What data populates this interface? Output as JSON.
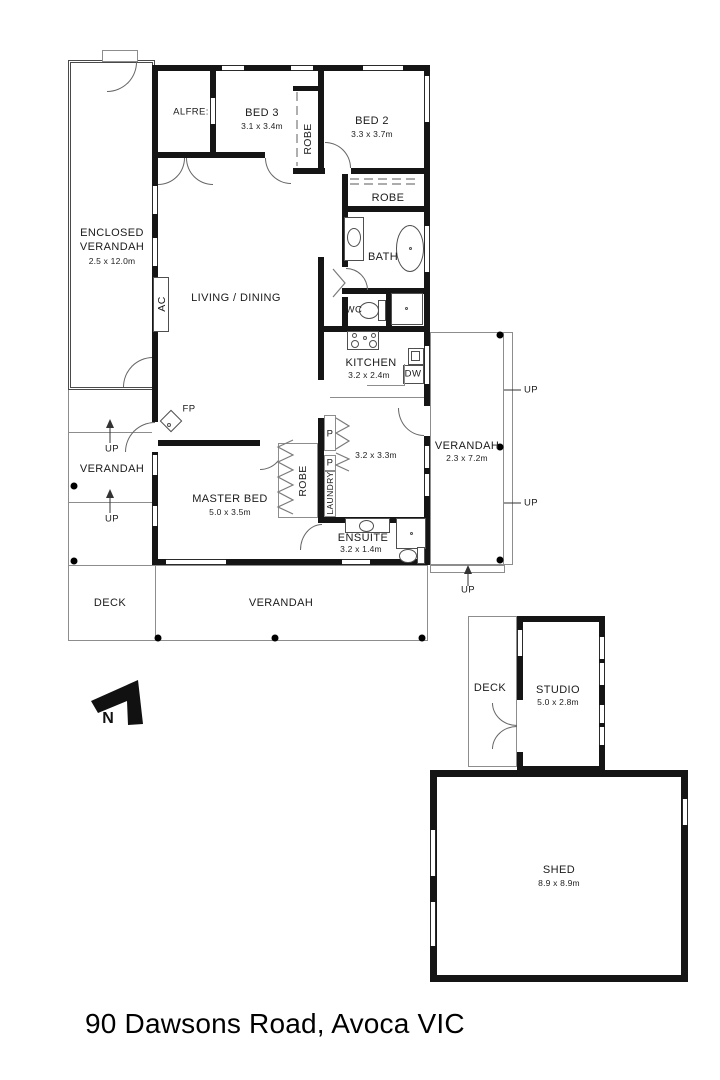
{
  "address_line": "90 Dawsons Road, Avoca VIC",
  "compass": {
    "label": "N"
  },
  "rooms": {
    "enclosed_verandah": {
      "line1": "ENCLOSED",
      "line2": "VERANDAH",
      "dims": "2.5 x 12.0m"
    },
    "alfresco": {
      "name": "ALFRE:"
    },
    "bed3": {
      "name": "BED 3",
      "dims": "3.1 x 3.4m"
    },
    "robe_beds": {
      "name": "ROBE"
    },
    "bed2": {
      "name": "BED 2",
      "dims": "3.3 x 3.7m"
    },
    "robe_hall": {
      "name": "ROBE"
    },
    "bath": {
      "name": "BATH"
    },
    "wc": {
      "name": "WC"
    },
    "living": {
      "name": "LIVING / DINING"
    },
    "ac": {
      "name": "AC"
    },
    "kitchen": {
      "name": "KITCHEN",
      "dims": "3.2 x 2.4m"
    },
    "dw": {
      "name": "DW"
    },
    "meals": {
      "dims": "3.2 x 3.3m"
    },
    "pantry_top": {
      "name": "P"
    },
    "pantry_bottom": {
      "name": "P"
    },
    "laundry": {
      "name": "LAUNDRY"
    },
    "fireplace": {
      "name": "FP"
    },
    "master": {
      "name": "MASTER BED",
      "dims": "5.0 x 3.5m"
    },
    "robe_master": {
      "name": "ROBE"
    },
    "ensuite": {
      "name": "ENSUITE",
      "dims": "3.2 x 1.4m"
    }
  },
  "outdoor": {
    "verandah_left": "VERANDAH",
    "verandah_right": {
      "name": "VERANDAH",
      "dims": "2.3 x 7.2m"
    },
    "verandah_bottom": "VERANDAH",
    "deck": "DECK",
    "up": "UP"
  },
  "outbuildings": {
    "studio_deck": "DECK",
    "studio": {
      "name": "STUDIO",
      "dims": "5.0 x 2.8m"
    },
    "shed": {
      "name": "SHED",
      "dims": "8.9 x 8.9m"
    }
  },
  "colors": {
    "wall": "#151515",
    "thin_line": "#8d8d8d",
    "text": "#1b1b1b",
    "background": "#ffffff"
  }
}
